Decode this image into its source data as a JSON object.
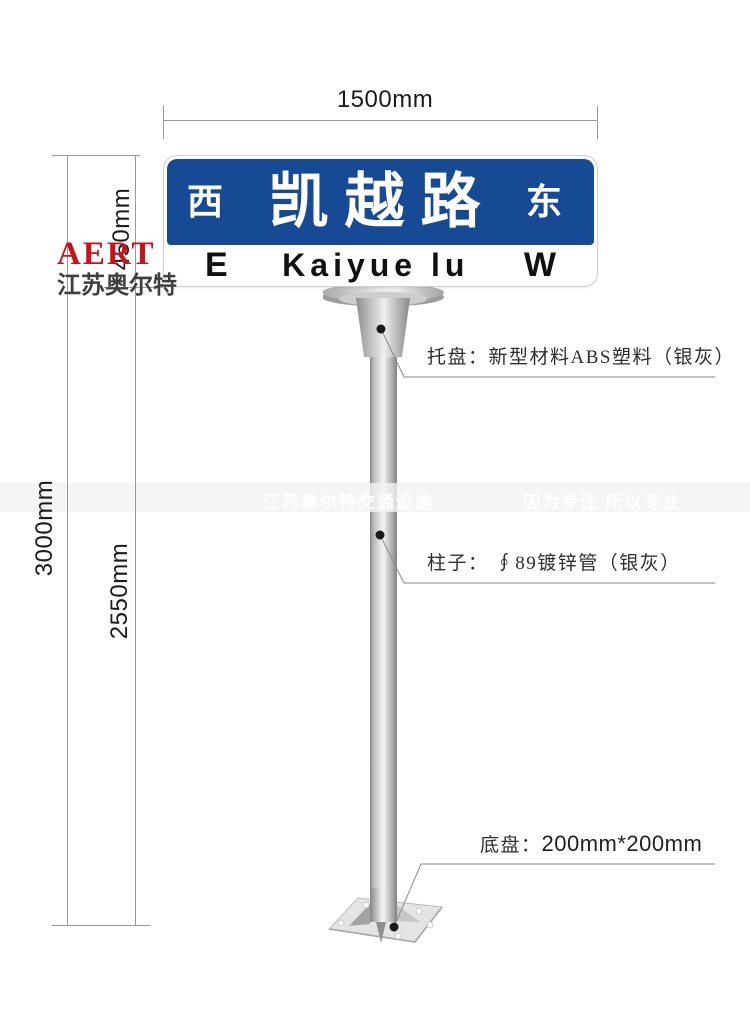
{
  "dimensions": {
    "sign_width": "1500mm",
    "sign_height": "450mm",
    "total_height": "3000mm",
    "pole_height": "2550mm"
  },
  "logo": {
    "brand": "AERT",
    "company": "江苏奥尔特"
  },
  "sign": {
    "cn_left": "西",
    "cn_name": "凯越路",
    "cn_right": "东",
    "en_left": "E",
    "en_name": "Kaiyue lu",
    "en_right": "W"
  },
  "annotations": {
    "tray": "托盘：新型材料ABS塑料（银灰）",
    "pole": "柱子： ∮89镀锌管（银灰）",
    "base_prefix": "底盘：",
    "base_size": "200mm*200mm"
  },
  "watermark": {
    "left": "江苏奥尔特交通设施",
    "right": "因为专注 所以专业"
  },
  "colors": {
    "sign_blue": "#164a94",
    "logo_red": "#c8131c",
    "dimension_line": "#999999",
    "leader_line": "#8a8a8a"
  }
}
